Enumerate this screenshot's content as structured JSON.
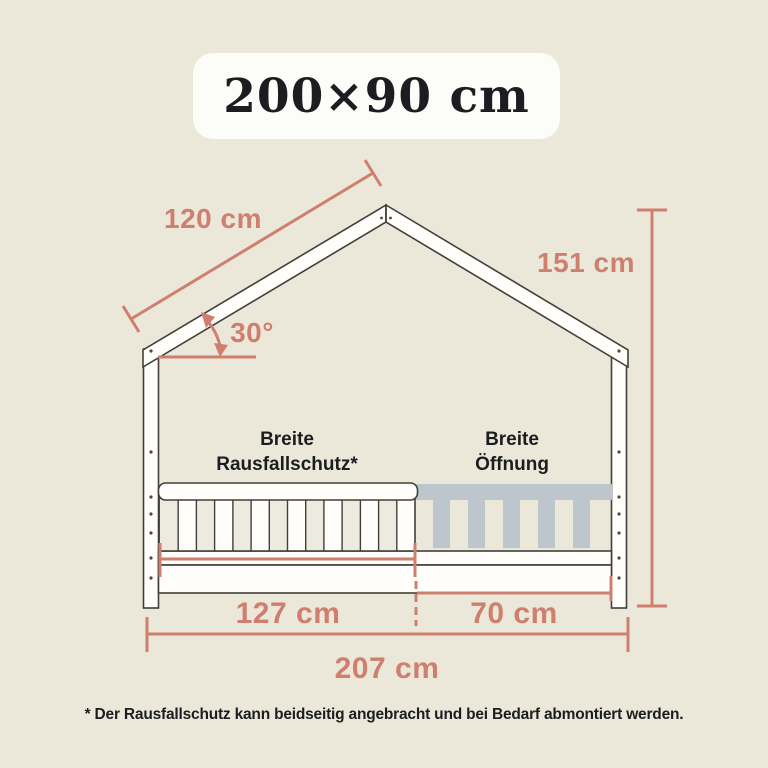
{
  "header_badge": {
    "label": "200×90 cm"
  },
  "labels": {
    "roof_length": "120 cm",
    "roof_angle": "30°",
    "total_height": "151 cm",
    "rail_section_caption": [
      "Breite",
      "Rausfallschutz*"
    ],
    "opening_section_caption": [
      "Breite",
      "Öffnung"
    ],
    "rail_width": "127 cm",
    "opening_width": "70 cm",
    "total_width": "207 cm"
  },
  "footnote": "* Der Rausfallschutz kann beidseitig angebracht und bei Bedarf abmontiert werden.",
  "colors": {
    "background": "#ebe8d9",
    "accent": "#cf7f6f",
    "outline": "#403f3a",
    "wood": "#fffefa",
    "ghost_rail": "#bcc6cc",
    "badge_bg": "#fcfcf8",
    "text": "#1c1d20"
  }
}
